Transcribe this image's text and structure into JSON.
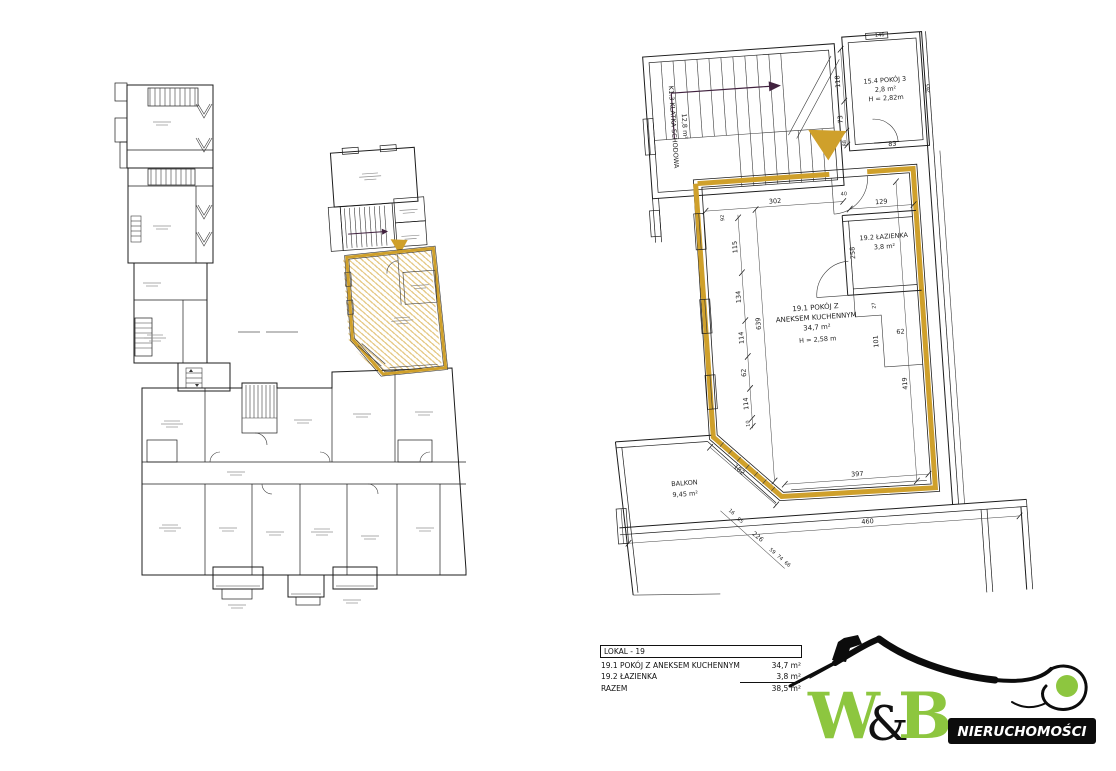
{
  "colors": {
    "gold": "#CFA02B",
    "green": "#8DC63F",
    "line": "#1c1c1c",
    "stair_arrow": "#41223F"
  },
  "detail_plan": {
    "staircase": {
      "l1": "K1.3 KLATKA SCHODOWA",
      "l2": "12,8 m²"
    },
    "room154": {
      "l1": "15.4 POKÓJ 3",
      "l2": "2,8 m²",
      "l3": "H = 2,82m"
    },
    "bathroom": {
      "l1": "19.2 ŁAZIENKA",
      "l2": "3,8 m²"
    },
    "main_room": {
      "l1": "19.1 POKÓJ Z",
      "l2": "ANEKSEM KUCHENNYM",
      "l3": "34,7 m²",
      "l4": "H = 2,58 m"
    },
    "balcony": {
      "l1": "BALKON",
      "l2": "9,45 m²"
    },
    "dims": {
      "top": "302",
      "w92": "92",
      "door": "40",
      "left": [
        "115",
        "134",
        "114",
        "62",
        "114",
        "10"
      ],
      "long_left": "639",
      "diag": "182",
      "bottom_inner": "397",
      "bottom_outer": "460",
      "right": "419",
      "bath_w": "129",
      "bath_h": "258",
      "n27": "27",
      "n101": "101",
      "n62": "62",
      "r154": [
        "118",
        "73",
        "88",
        "83",
        "146",
        "265"
      ],
      "balcony": [
        "16",
        "95",
        "226",
        "59",
        "74",
        "66"
      ]
    }
  },
  "legend": {
    "header": "LOKAL - 19",
    "rows": [
      {
        "no": "19.1",
        "name": "POKÓJ Z ANEKSEM KUCHENNYM",
        "area": "34,7 m²"
      },
      {
        "no": "19.2",
        "name": "ŁAZIENKA",
        "area": "3,8 m²"
      }
    ],
    "total_label": "RAZEM",
    "total_area": "38,5 m²"
  },
  "logo": {
    "w": "W",
    "amp": "&",
    "b": "B",
    "sub": "NIERUCHOMOŚCI"
  }
}
